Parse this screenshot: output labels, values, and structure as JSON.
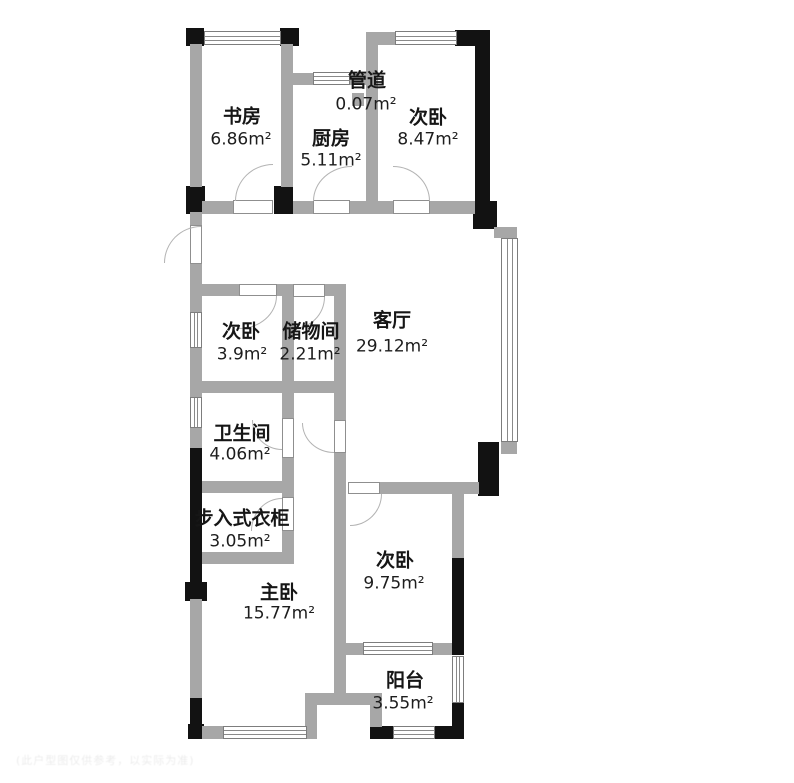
{
  "rooms": [
    {
      "id": "study",
      "name": "书房",
      "area": "6.86m²"
    },
    {
      "id": "kitchen",
      "name": "厨房",
      "area": "5.11m²"
    },
    {
      "id": "duct",
      "name": "管道",
      "area": "0.07m²"
    },
    {
      "id": "bedroom-top",
      "name": "次卧",
      "area": "8.47m²"
    },
    {
      "id": "bedroom-left",
      "name": "次卧",
      "area": "3.9m²"
    },
    {
      "id": "storage",
      "name": "储物间",
      "area": "2.21m²"
    },
    {
      "id": "living-room",
      "name": "客厅",
      "area": "29.12m²"
    },
    {
      "id": "bathroom",
      "name": "卫生间",
      "area": "4.06m²"
    },
    {
      "id": "walk-in-closet",
      "name": "步入式衣柜",
      "area": "3.05m²"
    },
    {
      "id": "master-bedroom",
      "name": "主卧",
      "area": "15.77m²"
    },
    {
      "id": "bedroom-bottom",
      "name": "次卧",
      "area": "9.75m²"
    },
    {
      "id": "balcony",
      "name": "阳台",
      "area": "3.55m²"
    }
  ],
  "watermark": "(此户型图仅供参考，以实际为准)",
  "colors": {
    "wall": "#a7a7a7",
    "column": "#121212",
    "background": "#ffffff"
  }
}
